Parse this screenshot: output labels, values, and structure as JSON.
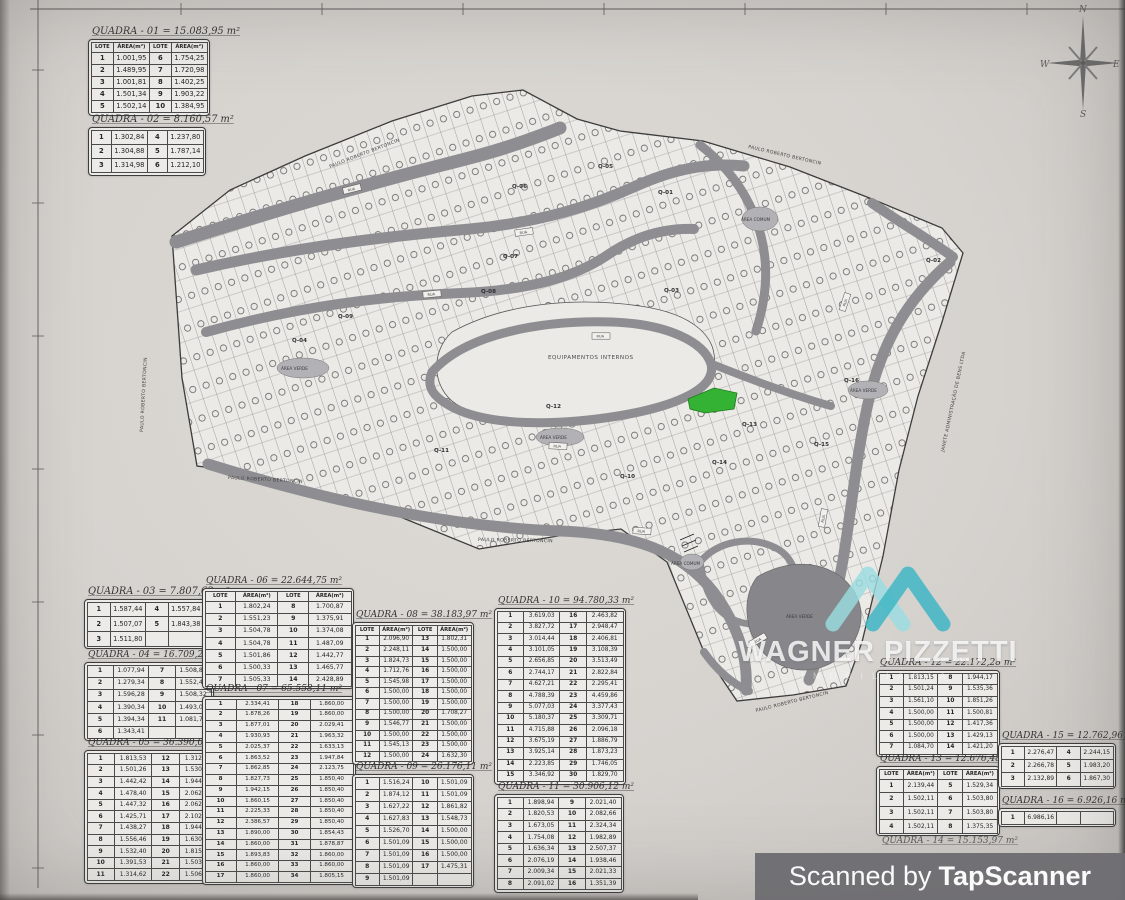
{
  "scan": {
    "scanned_by_prefix": "Scanned by",
    "scanner_name": "TapScanner"
  },
  "watermark": {
    "name": "WAGNER PIZZETTI",
    "subtitle": "IMOBILIÁRIA"
  },
  "compass": {
    "north": "N",
    "south": "S",
    "east": "E",
    "west": "W"
  },
  "table_header": {
    "lote": "LOTE",
    "area": "ÁREA(m²)"
  },
  "colors": {
    "highlight_green": "#33b233",
    "watermark_teal": "#3fb6c4",
    "watermark_teal_light": "#9adde0",
    "scan_bar_gray": "#6d6c70",
    "road_gray": "#8e8e92"
  },
  "map": {
    "equip_label": "EQUIPAMENTOS INTERNOS",
    "road_box_label": "RUA",
    "street_labels": [
      {
        "text": "PAULO ROBERTO BERTONCIN",
        "x": 330,
        "y": 168,
        "r": -21
      },
      {
        "text": "PAULO ROBERTO BERTONCIN",
        "x": 143,
        "y": 432,
        "r": -87
      },
      {
        "text": "PAULO ROBERTO BERTONCIN",
        "x": 228,
        "y": 479,
        "r": 3
      },
      {
        "text": "PAULO ROBERTO BERTONCIN",
        "x": 478,
        "y": 541,
        "r": 1
      },
      {
        "text": "PAULO ROBERTO BERTONCIN",
        "x": 756,
        "y": 712,
        "r": -14
      },
      {
        "text": "PAULO ROBERTO BERTONCIN",
        "x": 748,
        "y": 148,
        "r": 13
      },
      {
        "text": "JANETE ADMINISTRAÇÃO DE BENS LTDA",
        "x": 944,
        "y": 452,
        "r": -78
      }
    ],
    "block_labels": [
      {
        "text": "Q-01",
        "x": 658,
        "y": 194
      },
      {
        "text": "Q-02",
        "x": 926,
        "y": 262
      },
      {
        "text": "Q-03",
        "x": 664,
        "y": 292
      },
      {
        "text": "Q-04",
        "x": 292,
        "y": 342
      },
      {
        "text": "Q-05",
        "x": 598,
        "y": 168
      },
      {
        "text": "Q-06",
        "x": 512,
        "y": 188
      },
      {
        "text": "Q-07",
        "x": 503,
        "y": 258
      },
      {
        "text": "Q-08",
        "x": 481,
        "y": 293
      },
      {
        "text": "Q-09",
        "x": 338,
        "y": 318
      },
      {
        "text": "Q-10",
        "x": 620,
        "y": 478
      },
      {
        "text": "Q-11",
        "x": 434,
        "y": 452
      },
      {
        "text": "Q-12",
        "x": 546,
        "y": 408
      },
      {
        "text": "Q-13",
        "x": 742,
        "y": 426
      },
      {
        "text": "Q-14",
        "x": 712,
        "y": 464
      },
      {
        "text": "Q-15",
        "x": 814,
        "y": 446
      },
      {
        "text": "Q-16",
        "x": 844,
        "y": 382
      }
    ],
    "area_labels": [
      {
        "text": "ÁREA VERDE",
        "x": 281,
        "y": 370
      },
      {
        "text": "ÁREA VERDE",
        "x": 540,
        "y": 439
      },
      {
        "text": "ÁREA VERDE",
        "x": 850,
        "y": 392
      },
      {
        "text": "ÁREA VERDE",
        "x": 786,
        "y": 618
      },
      {
        "text": "ÁREA COMUM",
        "x": 741,
        "y": 221
      },
      {
        "text": "ÁREA COMUM",
        "x": 671,
        "y": 565
      }
    ]
  },
  "quadras": [
    {
      "id": "01",
      "title": "QUADRA - 01 = 15.083,95 m²",
      "header": true,
      "rows": [
        [
          "1",
          "1.001,95",
          "6",
          "1.754,25"
        ],
        [
          "2",
          "1.489,95",
          "7",
          "1.720,98"
        ],
        [
          "3",
          "1.001,81",
          "8",
          "1.402,25"
        ],
        [
          "4",
          "1.501,34",
          "9",
          "1.903,22"
        ],
        [
          "5",
          "1.502,14",
          "10",
          "1.384,95"
        ]
      ]
    },
    {
      "id": "02",
      "title": "QUADRA - 02 = 8.160,57 m²",
      "header": false,
      "rows": [
        [
          "1",
          "1.302,84",
          "4",
          "1.237,80"
        ],
        [
          "2",
          "1.304,88",
          "5",
          "1.787,14"
        ],
        [
          "3",
          "1.314,98",
          "6",
          "1.212,10"
        ]
      ]
    },
    {
      "id": "03",
      "title": "QUADRA - 03 = 7.807,63 m²",
      "header": false,
      "rows": [
        [
          "1",
          "1.587,44",
          "4",
          "1.557,84"
        ],
        [
          "2",
          "1.507,07",
          "5",
          "1.843,38"
        ],
        [
          "3",
          "1.511,80",
          "",
          ""
        ]
      ]
    },
    {
      "id": "04",
      "title": "QUADRA - 04 = 16.709,25 m²",
      "header": false,
      "rows": [
        [
          "1",
          "1.077,94",
          "7",
          "1.508,84"
        ],
        [
          "2",
          "1.279,34",
          "8",
          "1.552,41"
        ],
        [
          "3",
          "1.596,28",
          "9",
          "1.508,32"
        ],
        [
          "4",
          "1.390,34",
          "10",
          "1.493,08"
        ],
        [
          "5",
          "1.394,34",
          "11",
          "1.081,75"
        ],
        [
          "6",
          "1.343,41",
          "",
          ""
        ]
      ]
    },
    {
      "id": "05",
      "title": "QUADRA - 05 = 36.390,04 m²",
      "header": false,
      "rows": [
        [
          "1",
          "1.813,53",
          "12",
          "1.312,84"
        ],
        [
          "2",
          "1.501,26",
          "13",
          "1.530,42"
        ],
        [
          "3",
          "1.442,42",
          "14",
          "1.944,02"
        ],
        [
          "4",
          "1.478,40",
          "15",
          "2.062,45"
        ],
        [
          "5",
          "1.447,32",
          "16",
          "2.062,87"
        ],
        [
          "6",
          "1.425,71",
          "17",
          "2.102,00"
        ],
        [
          "7",
          "1.438,27",
          "18",
          "1.944,24"
        ],
        [
          "8",
          "1.556,46",
          "19",
          "1.630,23"
        ],
        [
          "9",
          "1.532,40",
          "20",
          "1.815,44"
        ],
        [
          "10",
          "1.391,53",
          "21",
          "1.503,18"
        ],
        [
          "11",
          "1.314,62",
          "22",
          "1.506,88"
        ]
      ]
    },
    {
      "id": "06",
      "title": "QUADRA - 06 = 22.644,75 m²",
      "header": true,
      "rows": [
        [
          "1",
          "1.802,24",
          "8",
          "1.700,87"
        ],
        [
          "2",
          "1.551,23",
          "9",
          "1.375,91"
        ],
        [
          "3",
          "1.504,78",
          "10",
          "1.374,08"
        ],
        [
          "4",
          "1.504,78",
          "11",
          "1.487,09"
        ],
        [
          "5",
          "1.501,86",
          "12",
          "1.442,77"
        ],
        [
          "6",
          "1.500,33",
          "13",
          "1.465,77"
        ],
        [
          "7",
          "1.505,33",
          "14",
          "2.428,89"
        ]
      ]
    },
    {
      "id": "07",
      "title": "QUADRA - 07 = 65.558,11 m²",
      "header": false,
      "rows": [
        [
          "1",
          "2.334,41",
          "18",
          "1.860,00"
        ],
        [
          "2",
          "1.878,26",
          "19",
          "1.860,00"
        ],
        [
          "3",
          "1.877,01",
          "20",
          "2.029,41"
        ],
        [
          "4",
          "1.930,93",
          "21",
          "1.963,32"
        ],
        [
          "5",
          "2.025,37",
          "22",
          "1.633,13"
        ],
        [
          "6",
          "1.863,52",
          "23",
          "1.947,84"
        ],
        [
          "7",
          "1.862,85",
          "24",
          "2.123,75"
        ],
        [
          "8",
          "1.827,73",
          "25",
          "1.850,40"
        ],
        [
          "9",
          "1.942,15",
          "26",
          "1.850,40"
        ],
        [
          "10",
          "1.860,15",
          "27",
          "1.850,40"
        ],
        [
          "11",
          "2.225,33",
          "28",
          "1.850,40"
        ],
        [
          "12",
          "2.386,57",
          "29",
          "1.850,40"
        ],
        [
          "13",
          "1.890,00",
          "30",
          "1.854,43"
        ],
        [
          "14",
          "1.860,00",
          "31",
          "1.878,87"
        ],
        [
          "15",
          "1.893,83",
          "32",
          "1.860,00"
        ],
        [
          "16",
          "1.860,00",
          "33",
          "1.860,00"
        ],
        [
          "17",
          "1.860,00",
          "34",
          "1.805,15"
        ]
      ]
    },
    {
      "id": "08",
      "title": "QUADRA - 08 = 38.183,97 m²",
      "header": true,
      "rows": [
        [
          "1",
          "2.096,90",
          "13",
          "1.802,31"
        ],
        [
          "2",
          "2.248,11",
          "14",
          "1.500,00"
        ],
        [
          "3",
          "1.824,73",
          "15",
          "1.500,00"
        ],
        [
          "4",
          "1.712,76",
          "16",
          "1.500,00"
        ],
        [
          "5",
          "1.545,98",
          "17",
          "1.500,00"
        ],
        [
          "6",
          "1.500,00",
          "18",
          "1.500,00"
        ],
        [
          "7",
          "1.500,00",
          "19",
          "1.500,00"
        ],
        [
          "8",
          "1.500,00",
          "20",
          "1.708,27"
        ],
        [
          "9",
          "1.546,77",
          "21",
          "1.500,00"
        ],
        [
          "10",
          "1.500,00",
          "22",
          "1.500,00"
        ],
        [
          "11",
          "1.545,13",
          "23",
          "1.500,00"
        ],
        [
          "12",
          "1.500,00",
          "24",
          "1.632,30"
        ]
      ]
    },
    {
      "id": "09",
      "title": "QUADRA - 09 = 26.176,11 m²",
      "header": false,
      "rows": [
        [
          "1",
          "1.516,24",
          "10",
          "1.501,09"
        ],
        [
          "2",
          "1.874,12",
          "11",
          "1.501,09"
        ],
        [
          "3",
          "1.627,22",
          "12",
          "1.861,82"
        ],
        [
          "4",
          "1.627,83",
          "13",
          "1.548,73"
        ],
        [
          "5",
          "1.526,70",
          "14",
          "1.500,00"
        ],
        [
          "6",
          "1.501,09",
          "15",
          "1.500,00"
        ],
        [
          "7",
          "1.501,09",
          "16",
          "1.500,00"
        ],
        [
          "8",
          "1.501,09",
          "17",
          "1.475,31"
        ],
        [
          "9",
          "1.501,09",
          "",
          ""
        ]
      ]
    },
    {
      "id": "10",
      "title": "QUADRA - 10 = 94.780,33 m²",
      "header": false,
      "rows": [
        [
          "1",
          "3.619,03",
          "16",
          "2.463,82"
        ],
        [
          "2",
          "3.827,72",
          "17",
          "2.948,47"
        ],
        [
          "3",
          "3.014,44",
          "18",
          "2.406,81"
        ],
        [
          "4",
          "3.101,05",
          "19",
          "3.108,39"
        ],
        [
          "5",
          "2.656,85",
          "20",
          "3.513,49"
        ],
        [
          "6",
          "2.744,17",
          "21",
          "2.822,84"
        ],
        [
          "7",
          "4.627,21",
          "22",
          "2.295,41"
        ],
        [
          "8",
          "4.788,39",
          "23",
          "4.459,86"
        ],
        [
          "9",
          "5.077,03",
          "24",
          "3.377,43"
        ],
        [
          "10",
          "5.180,37",
          "25",
          "3.309,71"
        ],
        [
          "11",
          "4.715,88",
          "26",
          "2.096,18"
        ],
        [
          "12",
          "3.675,19",
          "27",
          "1.886,79"
        ],
        [
          "13",
          "3.925,14",
          "28",
          "1.873,23"
        ],
        [
          "14",
          "2.223,85",
          "29",
          "1.746,05"
        ],
        [
          "15",
          "3.346,92",
          "30",
          "1.829,70"
        ]
      ]
    },
    {
      "id": "11",
      "title": "QUADRA - 11 = 30.906,12 m²",
      "header": false,
      "rows": [
        [
          "1",
          "1.898,94",
          "9",
          "2.021,40"
        ],
        [
          "2",
          "1.820,53",
          "10",
          "2.082,66"
        ],
        [
          "3",
          "1.673,05",
          "11",
          "2.324,34"
        ],
        [
          "4",
          "1.754,08",
          "12",
          "1.982,89"
        ],
        [
          "5",
          "1.636,34",
          "13",
          "2.507,37"
        ],
        [
          "6",
          "2.076,19",
          "14",
          "1.938,46"
        ],
        [
          "7",
          "2.009,34",
          "15",
          "2.021,33"
        ],
        [
          "8",
          "2.091,02",
          "16",
          "1.351,39"
        ]
      ]
    },
    {
      "id": "12",
      "title": "QUADRA - 12 = 22.172,28 m²",
      "header": false,
      "rows": [
        [
          "1",
          "1.813,15",
          "8",
          "1.944,17"
        ],
        [
          "2",
          "1.501,24",
          "9",
          "1.535,36"
        ],
        [
          "3",
          "1.561,10",
          "10",
          "1.851,26"
        ],
        [
          "4",
          "1.500,00",
          "11",
          "1.500,81"
        ],
        [
          "5",
          "1.500,00",
          "12",
          "1.417,36"
        ],
        [
          "6",
          "1.500,00",
          "13",
          "1.429,13"
        ],
        [
          "7",
          "1.084,70",
          "14",
          "1.421,20"
        ]
      ]
    },
    {
      "id": "13",
      "title": "QUADRA - 13 = 12.676,48 m²",
      "header": true,
      "rows": [
        [
          "1",
          "2.139,44",
          "5",
          "1.529,34"
        ],
        [
          "2",
          "1.502,11",
          "6",
          "1.503,80"
        ],
        [
          "3",
          "1.502,11",
          "7",
          "1.503,80"
        ],
        [
          "4",
          "1.502,11",
          "8",
          "1.375,35"
        ]
      ]
    },
    {
      "id": "14",
      "title": "QUADRA - 14 = 15.153,97 m²",
      "header": false,
      "rows": []
    },
    {
      "id": "15",
      "title": "QUADRA - 15 = 12.762,96 m²",
      "header": false,
      "rows": [
        [
          "1",
          "2.276,47",
          "4",
          "2.244,15"
        ],
        [
          "2",
          "2.266,78",
          "5",
          "1.983,20"
        ],
        [
          "3",
          "2.132,89",
          "6",
          "1.867,30"
        ]
      ]
    },
    {
      "id": "16",
      "title": "QUADRA - 16 = 6.926,16 m²",
      "header": false,
      "rows": [
        [
          "1",
          "6.986,16",
          "",
          ""
        ]
      ]
    }
  ]
}
